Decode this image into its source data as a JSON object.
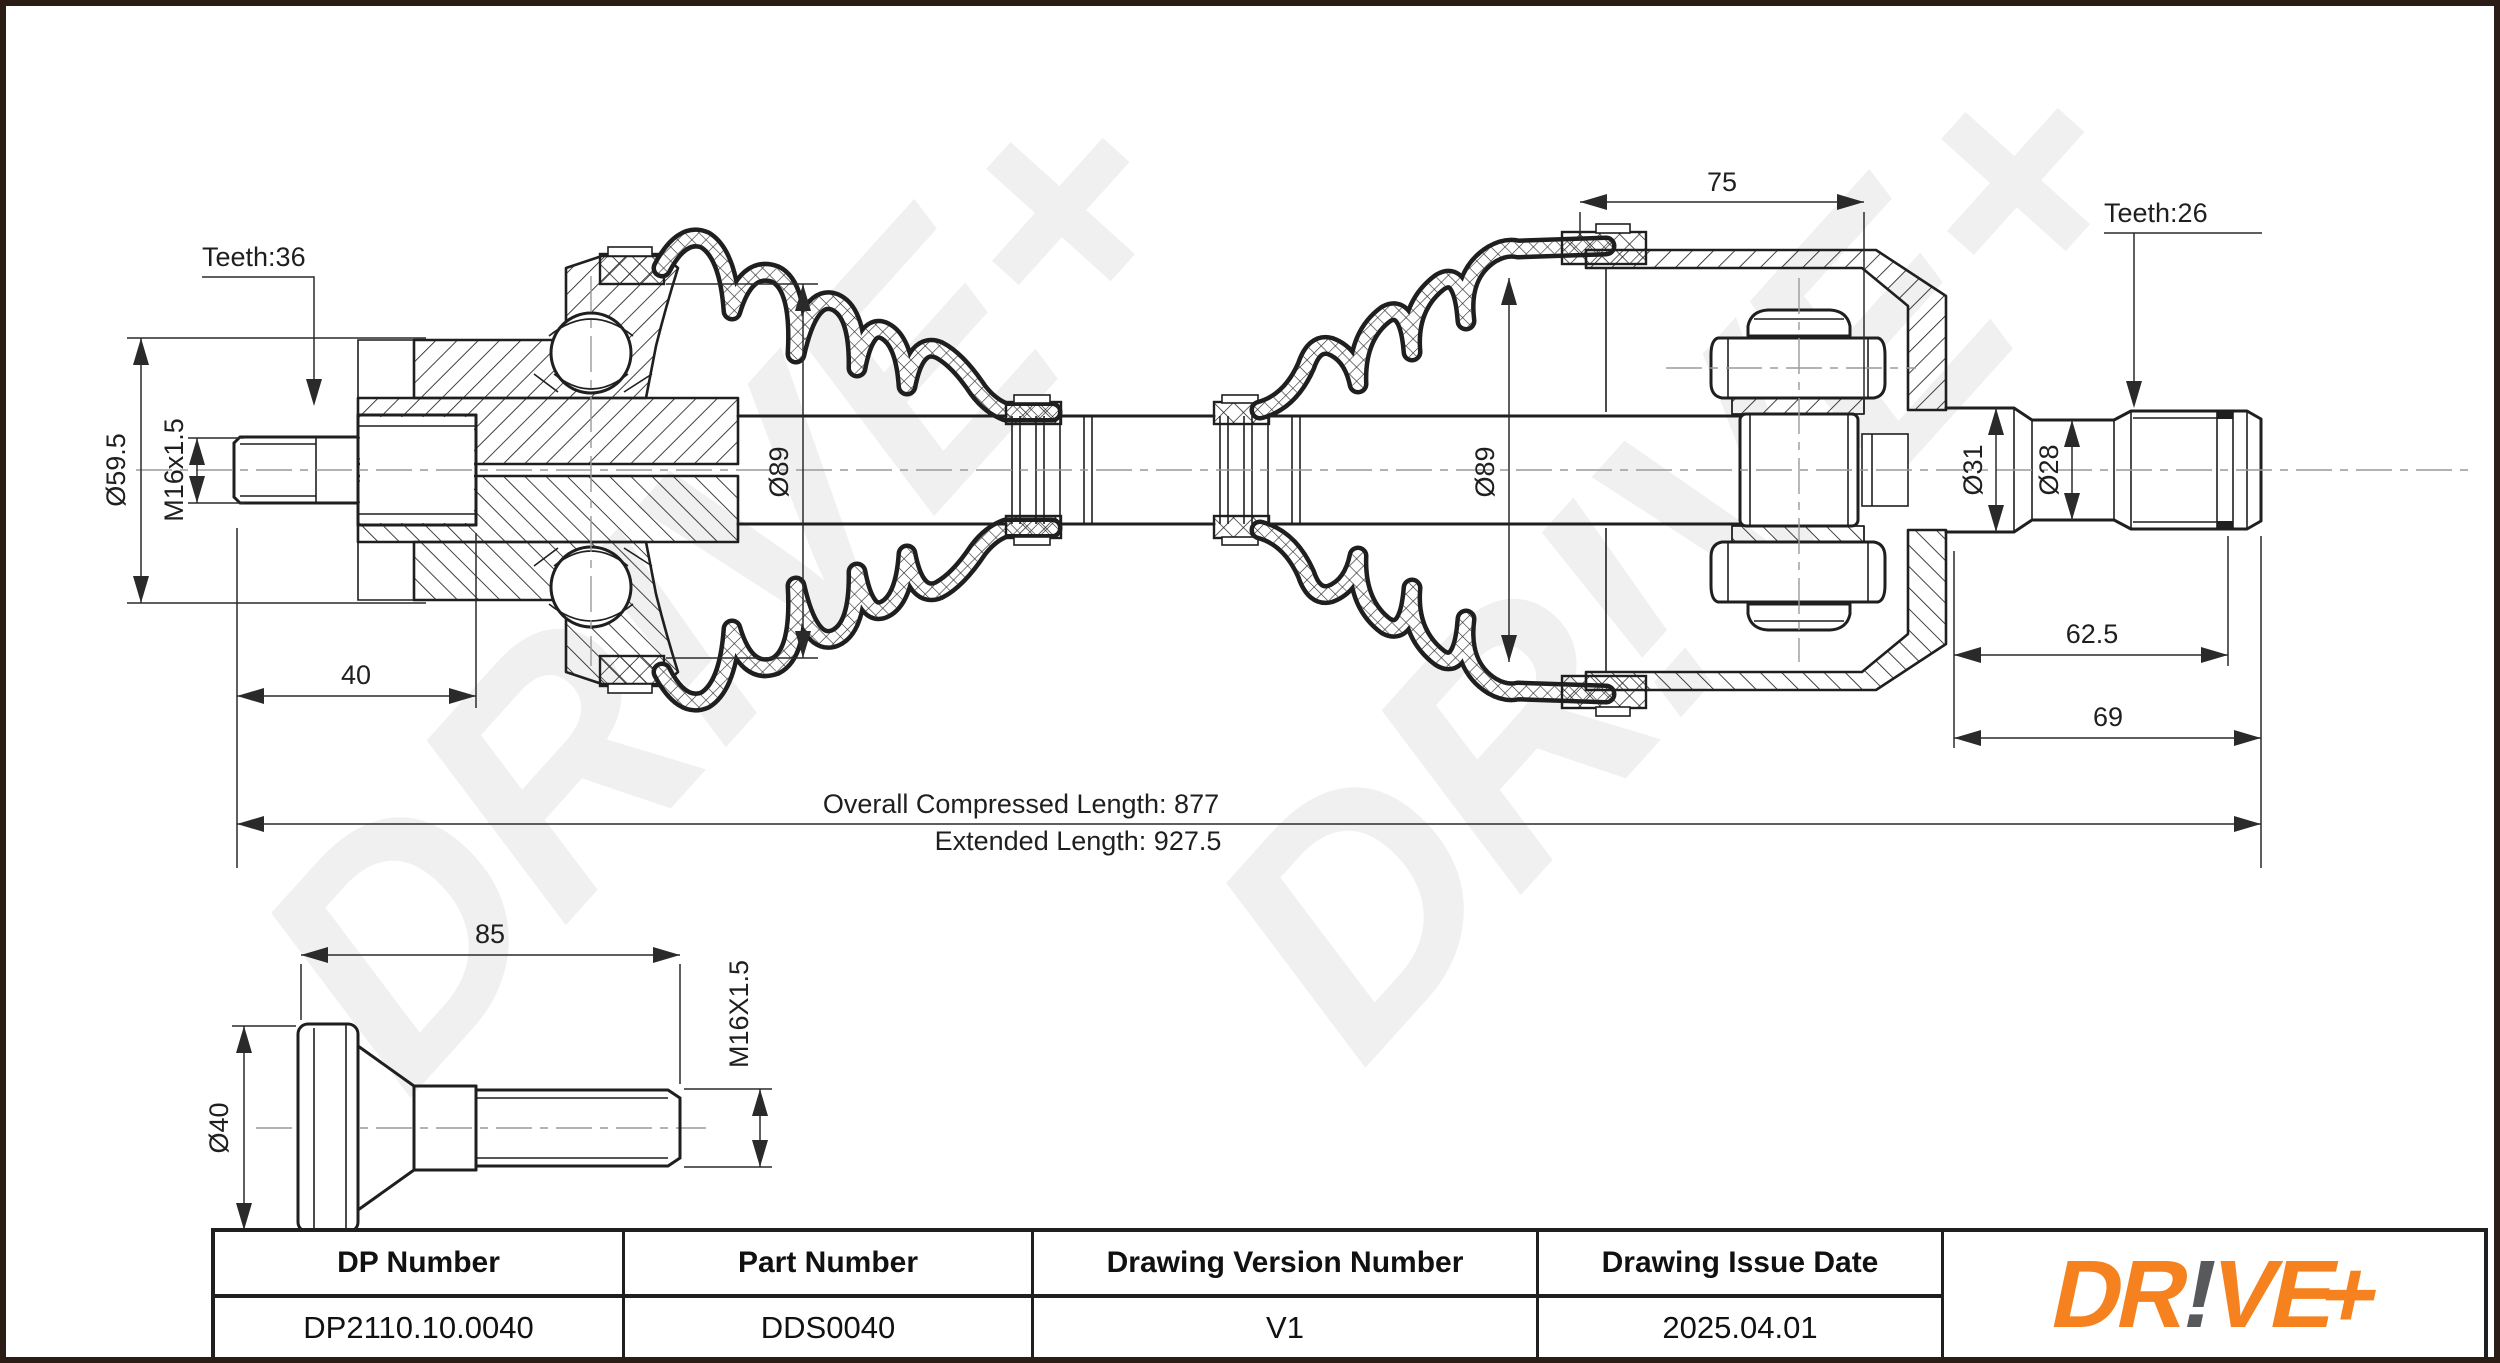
{
  "watermark": {
    "text": "DR!VE+",
    "color": "#f0f0f0"
  },
  "drawing": {
    "labels": {
      "teeth_left": "Teeth:36",
      "teeth_right": "Teeth:26"
    },
    "dimensions": {
      "spline_major_dia": "Ø59.5",
      "thread_spec": "M16x1.5",
      "stub_length": "40",
      "outer_boot_dia": "Ø89",
      "inner_joint_length": "75",
      "inner_boot_dia": "Ø89",
      "shaft_dia_1": "Ø31",
      "shaft_dia_2": "Ø28",
      "spline_length": "62.5",
      "shaft_end_length": "69",
      "overall_compressed": "Overall Compressed Length: 877",
      "extended": "Extended Length: 927.5"
    },
    "bolt": {
      "shank_length": "85",
      "flange_dia": "Ø40",
      "thread_spec": "M16X1.5"
    }
  },
  "title_block": {
    "columns": [
      {
        "header": "DP Number",
        "value": "DP2110.10.0040"
      },
      {
        "header": "Part Number",
        "value": "DDS0040"
      },
      {
        "header": "Drawing Version Number",
        "value": "V1"
      },
      {
        "header": "Drawing Issue Date",
        "value": "2025.04.01"
      }
    ],
    "logo": {
      "part1": "DR",
      "bang": "!",
      "part2": "VE",
      "plus": "+",
      "orange": "#f5821f",
      "gray": "#58595b"
    }
  }
}
